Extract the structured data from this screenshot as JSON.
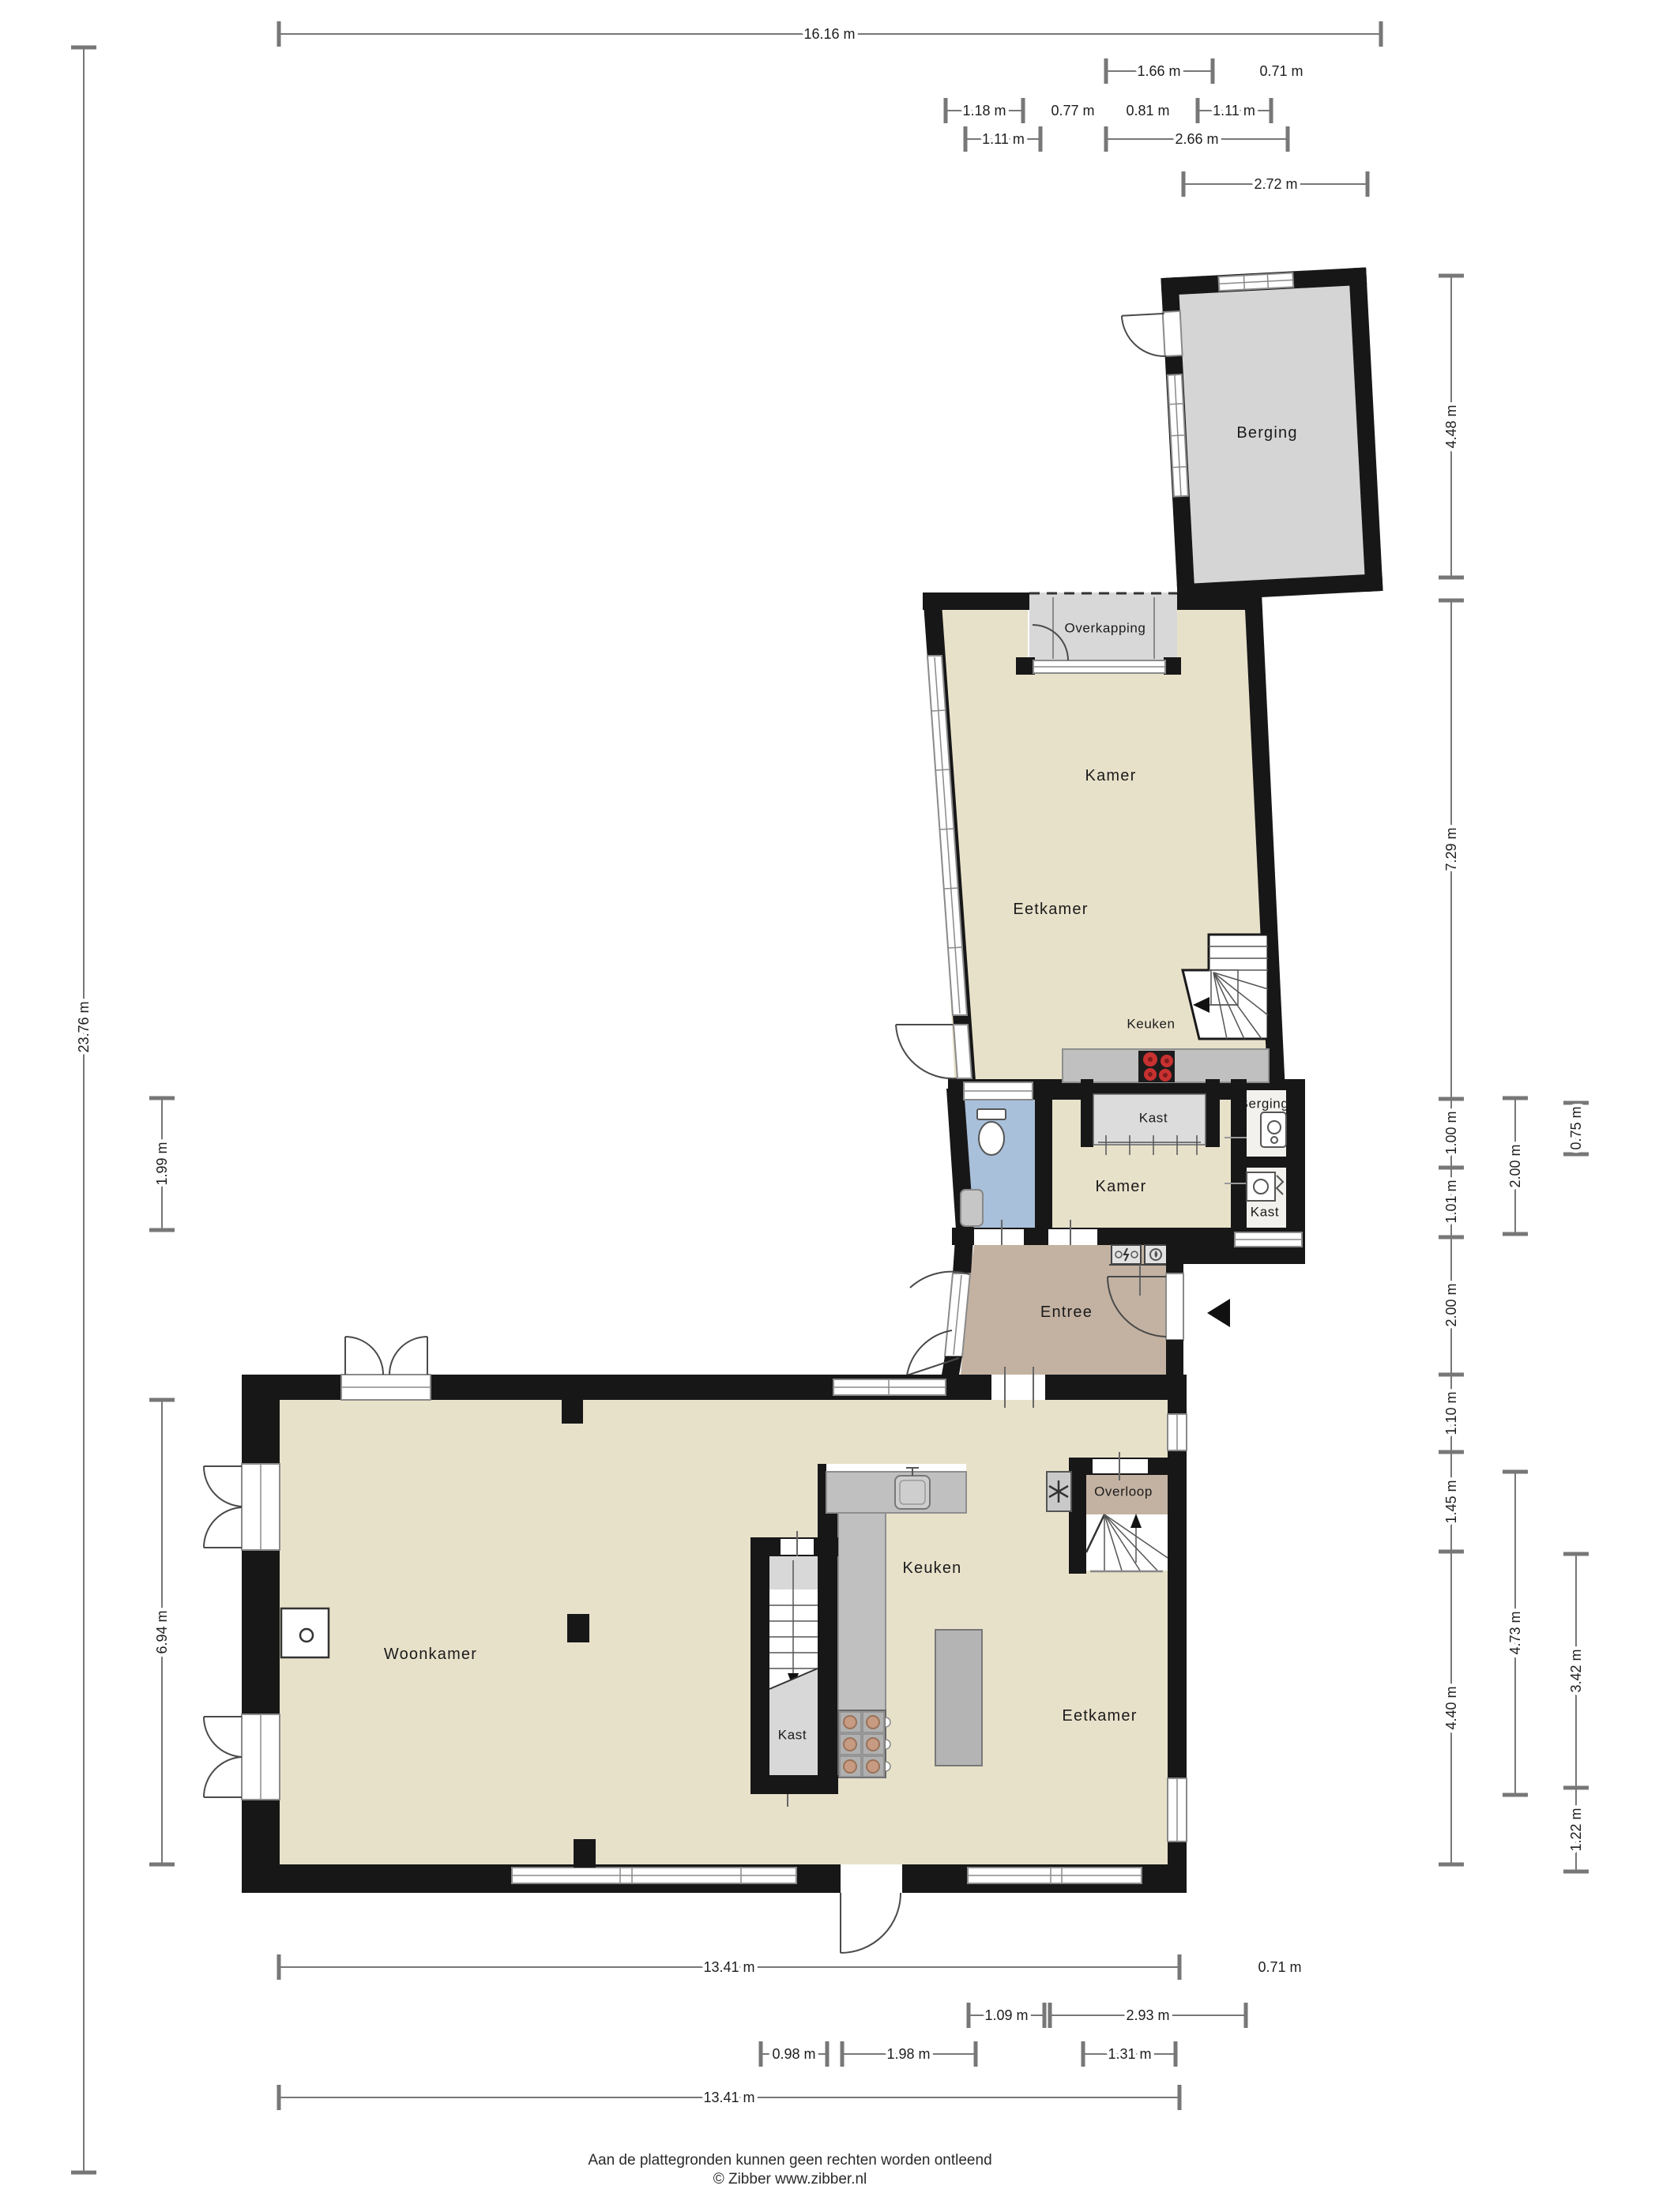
{
  "rooms": {
    "berging_shed": {
      "label": "Berging"
    },
    "overkapping": {
      "label": "Overkapping"
    },
    "kamer_upper": {
      "label": "Kamer"
    },
    "eetkamer_upper": {
      "label": "Eetkamer"
    },
    "keuken_upper": {
      "label": "Keuken"
    },
    "kast_wardrobe": {
      "label": "Kast"
    },
    "berging_utility": {
      "label": "Berging"
    },
    "kamer_hall": {
      "label": "Kamer"
    },
    "kast_utility": {
      "label": "Kast"
    },
    "entree": {
      "label": "Entree"
    },
    "woonkamer": {
      "label": "Woonkamer"
    },
    "keuken_lower": {
      "label": "Keuken"
    },
    "kast_stairs": {
      "label": "Kast"
    },
    "eetkamer_lower": {
      "label": "Eetkamer"
    },
    "overloop": {
      "label": "Overloop"
    }
  },
  "dimensions": {
    "top": [
      {
        "label": "16.16 m"
      },
      {
        "label": "1.66 m"
      },
      {
        "label": "0.71 m"
      },
      {
        "label": "1.18 m"
      },
      {
        "label": "0.77 m"
      },
      {
        "label": "0.81 m"
      },
      {
        "label": "1.11 m"
      },
      {
        "label": "1.11 m"
      },
      {
        "label": "2.66 m"
      },
      {
        "label": "2.72 m"
      }
    ],
    "left": [
      {
        "label": "23.76 m"
      },
      {
        "label": "1.99 m"
      },
      {
        "label": "6.94 m"
      }
    ],
    "right": [
      {
        "label": "4.48 m"
      },
      {
        "label": "7.29 m"
      },
      {
        "label": "1.00 m"
      },
      {
        "label": "1.01 m"
      },
      {
        "label": "2.00 m"
      },
      {
        "label": "1.10 m"
      },
      {
        "label": "1.45 m"
      },
      {
        "label": "4.40 m"
      },
      {
        "label": "2.00 m"
      },
      {
        "label": "4.73 m"
      },
      {
        "label": "0.75 m"
      },
      {
        "label": "3.42 m"
      },
      {
        "label": "1.22 m"
      }
    ],
    "bottom": [
      {
        "label": "13.41 m"
      },
      {
        "label": "0.71 m"
      },
      {
        "label": "1.09 m"
      },
      {
        "label": "2.93 m"
      },
      {
        "label": "0.98 m"
      },
      {
        "label": "1.98 m"
      },
      {
        "label": "1.31 m"
      },
      {
        "label": "13.41 m"
      }
    ]
  },
  "footer": {
    "disclaimer": "Aan de plattegronden kunnen geen rechten worden ontleend",
    "copyright": "© Zibber www.zibber.nl"
  },
  "colors": {
    "wall": "#171717",
    "floor_beige": "#e8e1ca",
    "floor_taupe": "#c3b2a2",
    "floor_blue": "#a9c0da",
    "floor_gray": "#d5d5d5",
    "counter_gray": "#c0c0c0",
    "burner_red": "#c93131"
  }
}
